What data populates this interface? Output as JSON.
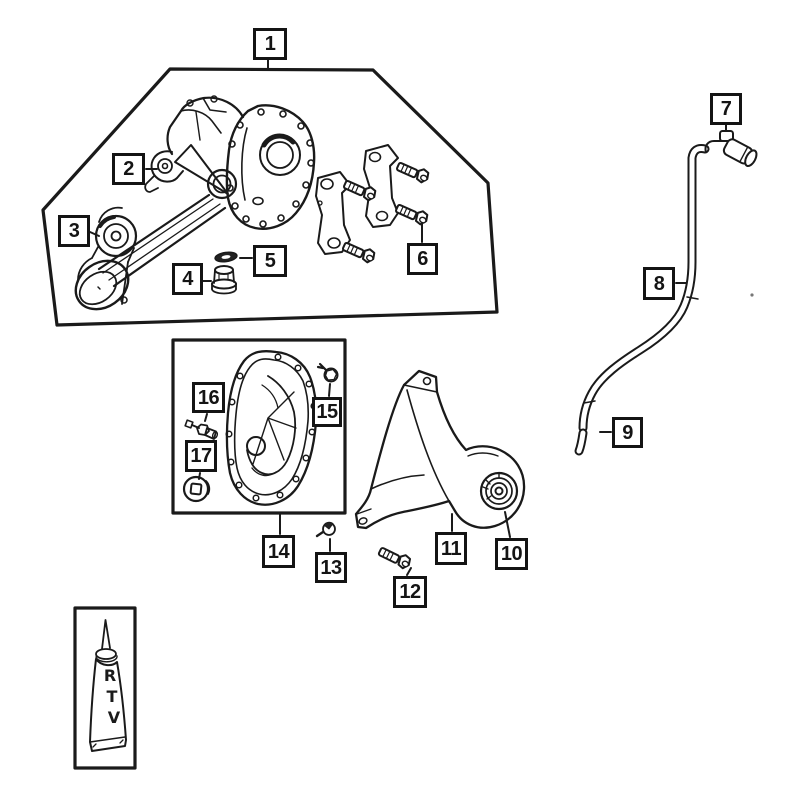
{
  "colors": {
    "background": "#ffffff",
    "line": "#1a1a1a"
  },
  "callouts": [
    {
      "label": "1"
    },
    {
      "label": "2"
    },
    {
      "label": "3"
    },
    {
      "label": "4"
    },
    {
      "label": "5"
    },
    {
      "label": "6"
    },
    {
      "label": "7"
    },
    {
      "label": "8"
    },
    {
      "label": "9"
    },
    {
      "label": "10"
    },
    {
      "label": "11"
    },
    {
      "label": "12"
    },
    {
      "label": "13"
    },
    {
      "label": "14"
    },
    {
      "label": "15"
    },
    {
      "label": "16"
    },
    {
      "label": "17"
    }
  ],
  "rtv": {
    "letters": [
      "R",
      "T",
      "V"
    ]
  }
}
